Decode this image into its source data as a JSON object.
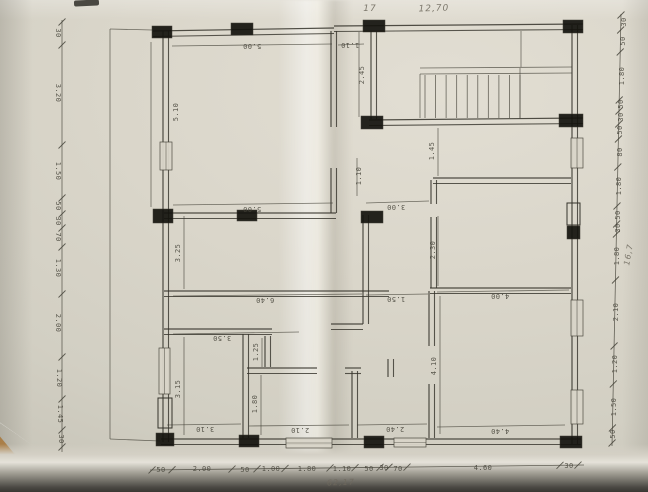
{
  "colors": {
    "paper": "#d9d5c9",
    "ink": "#46443a",
    "wall": "#35332b",
    "column": "#14130e",
    "pencil": "#6f6a5e"
  },
  "plan": {
    "pencil_notes_visible": [
      "17",
      "12,70",
      "62,17",
      "16,7"
    ],
    "dim_chain_left": [
      "30",
      "3.20",
      "1.50",
      "50",
      "30",
      "70",
      "1.30",
      "2.00",
      "1.20",
      "1.45",
      "30"
    ],
    "dim_chain_right": [
      "30",
      "50",
      "1.80",
      "50",
      "30",
      "50",
      "80",
      "1.80",
      "50",
      "30",
      "1.80",
      "2.10",
      "1.20",
      "1.50",
      "50"
    ],
    "dim_chain_bottom": [
      "50",
      "2.00",
      "50",
      "1.00",
      "1.80",
      "1.10",
      "50",
      "30",
      "70",
      "4.60",
      "30"
    ],
    "room_dimensions": [
      "5.00",
      "1.10",
      "5.10",
      "2.45",
      "1.45",
      "5.00",
      "3.00",
      "1.10",
      "3.25",
      "2.30",
      "6.40",
      "1.50",
      "4.00",
      "3.50",
      "1.25",
      "3.15",
      "1.80",
      "4.10",
      "3.10",
      "2.10",
      "2.40",
      "4.40"
    ],
    "lines": [
      [
        110,
        29,
        110,
        439
      ],
      [
        110,
        439,
        160,
        441
      ],
      [
        110,
        29,
        152,
        30
      ],
      [
        420,
        68,
        572,
        67
      ],
      [
        420,
        74,
        572,
        73
      ],
      [
        420,
        74,
        420,
        118
      ],
      [
        520,
        68,
        520,
        118
      ],
      [
        521,
        31,
        521,
        67
      ],
      [
        172,
        46,
        332,
        44
      ],
      [
        338,
        45,
        364,
        44
      ],
      [
        151,
        42,
        151,
        207
      ],
      [
        173,
        205,
        333,
        203
      ],
      [
        366,
        203,
        429,
        201
      ],
      [
        359,
        32,
        359,
        117
      ],
      [
        438,
        128,
        438,
        176
      ],
      [
        173,
        296,
        362,
        294
      ],
      [
        366,
        295,
        428,
        294
      ],
      [
        437,
        292,
        569,
        290
      ],
      [
        184,
        216,
        184,
        289
      ],
      [
        438,
        216,
        438,
        286
      ],
      [
        357,
        158,
        357,
        196
      ],
      [
        173,
        334,
        299,
        332
      ],
      [
        262,
        338,
        262,
        367
      ],
      [
        184,
        337,
        184,
        435
      ],
      [
        261,
        375,
        261,
        435
      ],
      [
        440,
        296,
        440,
        434
      ],
      [
        167,
        425,
        241,
        424
      ],
      [
        249,
        426,
        349,
        425
      ],
      [
        357,
        425,
        427,
        424
      ],
      [
        437,
        427,
        565,
        425
      ]
    ],
    "dwalls": [
      [
        153,
        31,
        334,
        28
      ],
      [
        334,
        26,
        583,
        24
      ],
      [
        163,
        31,
        163,
        442
      ],
      [
        572,
        25,
        572,
        444
      ],
      [
        161,
        439,
        581,
        439
      ],
      [
        371,
        31,
        371,
        119
      ],
      [
        369,
        120,
        583,
        118
      ],
      [
        331,
        31,
        331,
        127
      ],
      [
        331,
        168,
        331,
        213
      ],
      [
        164,
        213,
        336,
        213
      ],
      [
        363,
        215,
        363,
        324
      ],
      [
        331,
        324,
        363,
        324
      ],
      [
        433,
        178,
        571,
        178
      ],
      [
        431,
        180,
        431,
        204
      ],
      [
        431,
        217,
        431,
        288
      ],
      [
        430,
        288,
        571,
        288
      ],
      [
        164,
        291,
        389,
        291
      ],
      [
        429,
        291,
        429,
        346
      ],
      [
        429,
        384,
        429,
        438
      ],
      [
        164,
        329,
        272,
        329
      ],
      [
        243,
        334,
        243,
        438
      ],
      [
        265,
        336,
        265,
        367
      ],
      [
        247,
        368,
        317,
        368
      ],
      [
        345,
        368,
        361,
        368
      ],
      [
        352,
        371,
        352,
        438
      ],
      [
        388,
        359,
        388,
        377
      ]
    ],
    "columns": [
      [
        152,
        26,
        20,
        12
      ],
      [
        231,
        23,
        22,
        12
      ],
      [
        363,
        20,
        22,
        12
      ],
      [
        563,
        20,
        20,
        13
      ],
      [
        361,
        116,
        22,
        13
      ],
      [
        559,
        114,
        24,
        13
      ],
      [
        153,
        209,
        20,
        14
      ],
      [
        237,
        210,
        20,
        11
      ],
      [
        361,
        211,
        22,
        12
      ],
      [
        156,
        433,
        18,
        13
      ],
      [
        239,
        435,
        20,
        12
      ],
      [
        364,
        436,
        20,
        12
      ],
      [
        560,
        436,
        22,
        12
      ],
      [
        567,
        226,
        13,
        13
      ]
    ],
    "piers": [
      [
        567,
        203,
        13,
        22
      ],
      [
        158,
        398,
        14,
        30
      ]
    ],
    "windows": [
      [
        160,
        142,
        12,
        28
      ],
      [
        159,
        348,
        11,
        46
      ],
      [
        571,
        138,
        12,
        30
      ],
      [
        571,
        300,
        12,
        36
      ],
      [
        571,
        390,
        12,
        34
      ],
      [
        286,
        438,
        46,
        10
      ],
      [
        394,
        438,
        32,
        9
      ]
    ],
    "stairs": {
      "x1": 425,
      "x2": 520,
      "y": 75,
      "h": 43,
      "steps": 9
    },
    "chains": [
      {
        "x1": 62,
        "y1": 20,
        "x2": 62,
        "y2": 452,
        "ticks": [
          22,
          45,
          145,
          198,
          214,
          228,
          247,
          294,
          357,
          399,
          430,
          447
        ]
      },
      {
        "x1": 621,
        "y1": 14,
        "x2": 612,
        "y2": 446,
        "ticks": [
          15,
          30,
          52,
          100,
          111,
          124,
          139,
          167,
          206,
          224,
          234,
          280,
          346,
          384,
          428,
          443
        ]
      },
      {
        "x1": 150,
        "y1": 470,
        "x2": 584,
        "y2": 465,
        "ticks": [
          152,
          172,
          232,
          257,
          285,
          330,
          355,
          380,
          389,
          407,
          560,
          578
        ]
      }
    ],
    "labels": [
      {
        "t": "5.00",
        "x": 252,
        "y": 44,
        "r": 180
      },
      {
        "t": "1.10",
        "x": 350,
        "y": 43,
        "r": 180
      },
      {
        "t": "5.00",
        "x": 252,
        "y": 207,
        "r": 180
      },
      {
        "t": "3.00",
        "x": 396,
        "y": 205,
        "r": 180
      },
      {
        "t": "6.40",
        "x": 265,
        "y": 298,
        "r": 180
      },
      {
        "t": "1.50",
        "x": 396,
        "y": 297,
        "r": 180
      },
      {
        "t": "4.00",
        "x": 500,
        "y": 294,
        "r": 180
      },
      {
        "t": "3.50",
        "x": 222,
        "y": 336,
        "r": 180
      },
      {
        "t": "3.10",
        "x": 205,
        "y": 427,
        "r": 180
      },
      {
        "t": "2.10",
        "x": 300,
        "y": 428,
        "r": 180
      },
      {
        "t": "2.40",
        "x": 395,
        "y": 427,
        "r": 180
      },
      {
        "t": "4.40",
        "x": 500,
        "y": 429,
        "r": 180
      },
      {
        "t": "5.10",
        "x": 178,
        "y": 112,
        "r": -90
      },
      {
        "t": "2.45",
        "x": 364,
        "y": 75,
        "r": -90
      },
      {
        "t": "1.10",
        "x": 361,
        "y": 176,
        "r": -90
      },
      {
        "t": "1.45",
        "x": 434,
        "y": 151,
        "r": -90
      },
      {
        "t": "3.25",
        "x": 180,
        "y": 253,
        "r": -90
      },
      {
        "t": "2.30",
        "x": 435,
        "y": 250,
        "r": -90
      },
      {
        "t": "1.25",
        "x": 258,
        "y": 352,
        "r": -90
      },
      {
        "t": "3.15",
        "x": 180,
        "y": 389,
        "r": -90
      },
      {
        "t": "1.80",
        "x": 257,
        "y": 404,
        "r": -90
      },
      {
        "t": "4.10",
        "x": 436,
        "y": 366,
        "r": -90
      },
      {
        "t": "30",
        "x": 56,
        "y": 33,
        "r": 90
      },
      {
        "t": "3.20",
        "x": 56,
        "y": 93,
        "r": 90
      },
      {
        "t": "1.50",
        "x": 56,
        "y": 171,
        "r": 90
      },
      {
        "t": "50",
        "x": 56,
        "y": 206,
        "r": 90
      },
      {
        "t": "30",
        "x": 56,
        "y": 221,
        "r": 90
      },
      {
        "t": "70",
        "x": 56,
        "y": 237,
        "r": 90
      },
      {
        "t": "1.30",
        "x": 56,
        "y": 268,
        "r": 90
      },
      {
        "t": "2.00",
        "x": 56,
        "y": 323,
        "r": 90
      },
      {
        "t": "1.20",
        "x": 57,
        "y": 378,
        "r": 90
      },
      {
        "t": "1.45",
        "x": 58,
        "y": 414,
        "r": 90
      },
      {
        "t": "30",
        "x": 59,
        "y": 439,
        "r": 90
      },
      {
        "t": "30",
        "x": 626,
        "y": 22,
        "r": -90
      },
      {
        "t": "50",
        "x": 625,
        "y": 41,
        "r": -90
      },
      {
        "t": "1.80",
        "x": 624,
        "y": 76,
        "r": -90
      },
      {
        "t": "50",
        "x": 623,
        "y": 104,
        "r": -90
      },
      {
        "t": "30",
        "x": 623,
        "y": 117,
        "r": -90
      },
      {
        "t": "50",
        "x": 622,
        "y": 130,
        "r": -90
      },
      {
        "t": "80",
        "x": 622,
        "y": 152,
        "r": -90
      },
      {
        "t": "1.80",
        "x": 621,
        "y": 186,
        "r": -90
      },
      {
        "t": "50",
        "x": 620,
        "y": 215,
        "r": -90
      },
      {
        "t": "30",
        "x": 620,
        "y": 228,
        "r": -90
      },
      {
        "t": "1.80",
        "x": 619,
        "y": 256,
        "r": -90
      },
      {
        "t": "2.10",
        "x": 618,
        "y": 312,
        "r": -90
      },
      {
        "t": "1.20",
        "x": 617,
        "y": 364,
        "r": -90
      },
      {
        "t": "1.50",
        "x": 616,
        "y": 407,
        "r": -90
      },
      {
        "t": "50",
        "x": 615,
        "y": 434,
        "r": -90
      },
      {
        "t": "50",
        "x": 161,
        "y": 472,
        "r": 0
      },
      {
        "t": "2.00",
        "x": 202,
        "y": 471,
        "r": 0
      },
      {
        "t": "50",
        "x": 245,
        "y": 472,
        "r": 0
      },
      {
        "t": "1.00",
        "x": 271,
        "y": 471,
        "r": 0
      },
      {
        "t": "1.80",
        "x": 307,
        "y": 471,
        "r": 0
      },
      {
        "t": "1.10",
        "x": 342,
        "y": 471,
        "r": 0
      },
      {
        "t": "50",
        "x": 369,
        "y": 471,
        "r": 0
      },
      {
        "t": "30",
        "x": 384,
        "y": 470,
        "r": 0
      },
      {
        "t": "70",
        "x": 398,
        "y": 471,
        "r": 0
      },
      {
        "t": "4.60",
        "x": 483,
        "y": 470,
        "r": 0
      },
      {
        "t": "30",
        "x": 569,
        "y": 468,
        "r": 0
      },
      {
        "t": "17",
        "x": 370,
        "y": 11,
        "r": 0,
        "s": 9,
        "c": "pencil"
      },
      {
        "t": "12,70",
        "x": 434,
        "y": 11,
        "r": -2,
        "s": 9,
        "c": "pencil"
      },
      {
        "t": "62,17",
        "x": 341,
        "y": 485,
        "r": -2,
        "s": 8,
        "c": "pencil"
      },
      {
        "t": "16,7",
        "x": 631,
        "y": 255,
        "r": -80,
        "s": 8,
        "c": "pencil"
      }
    ]
  }
}
